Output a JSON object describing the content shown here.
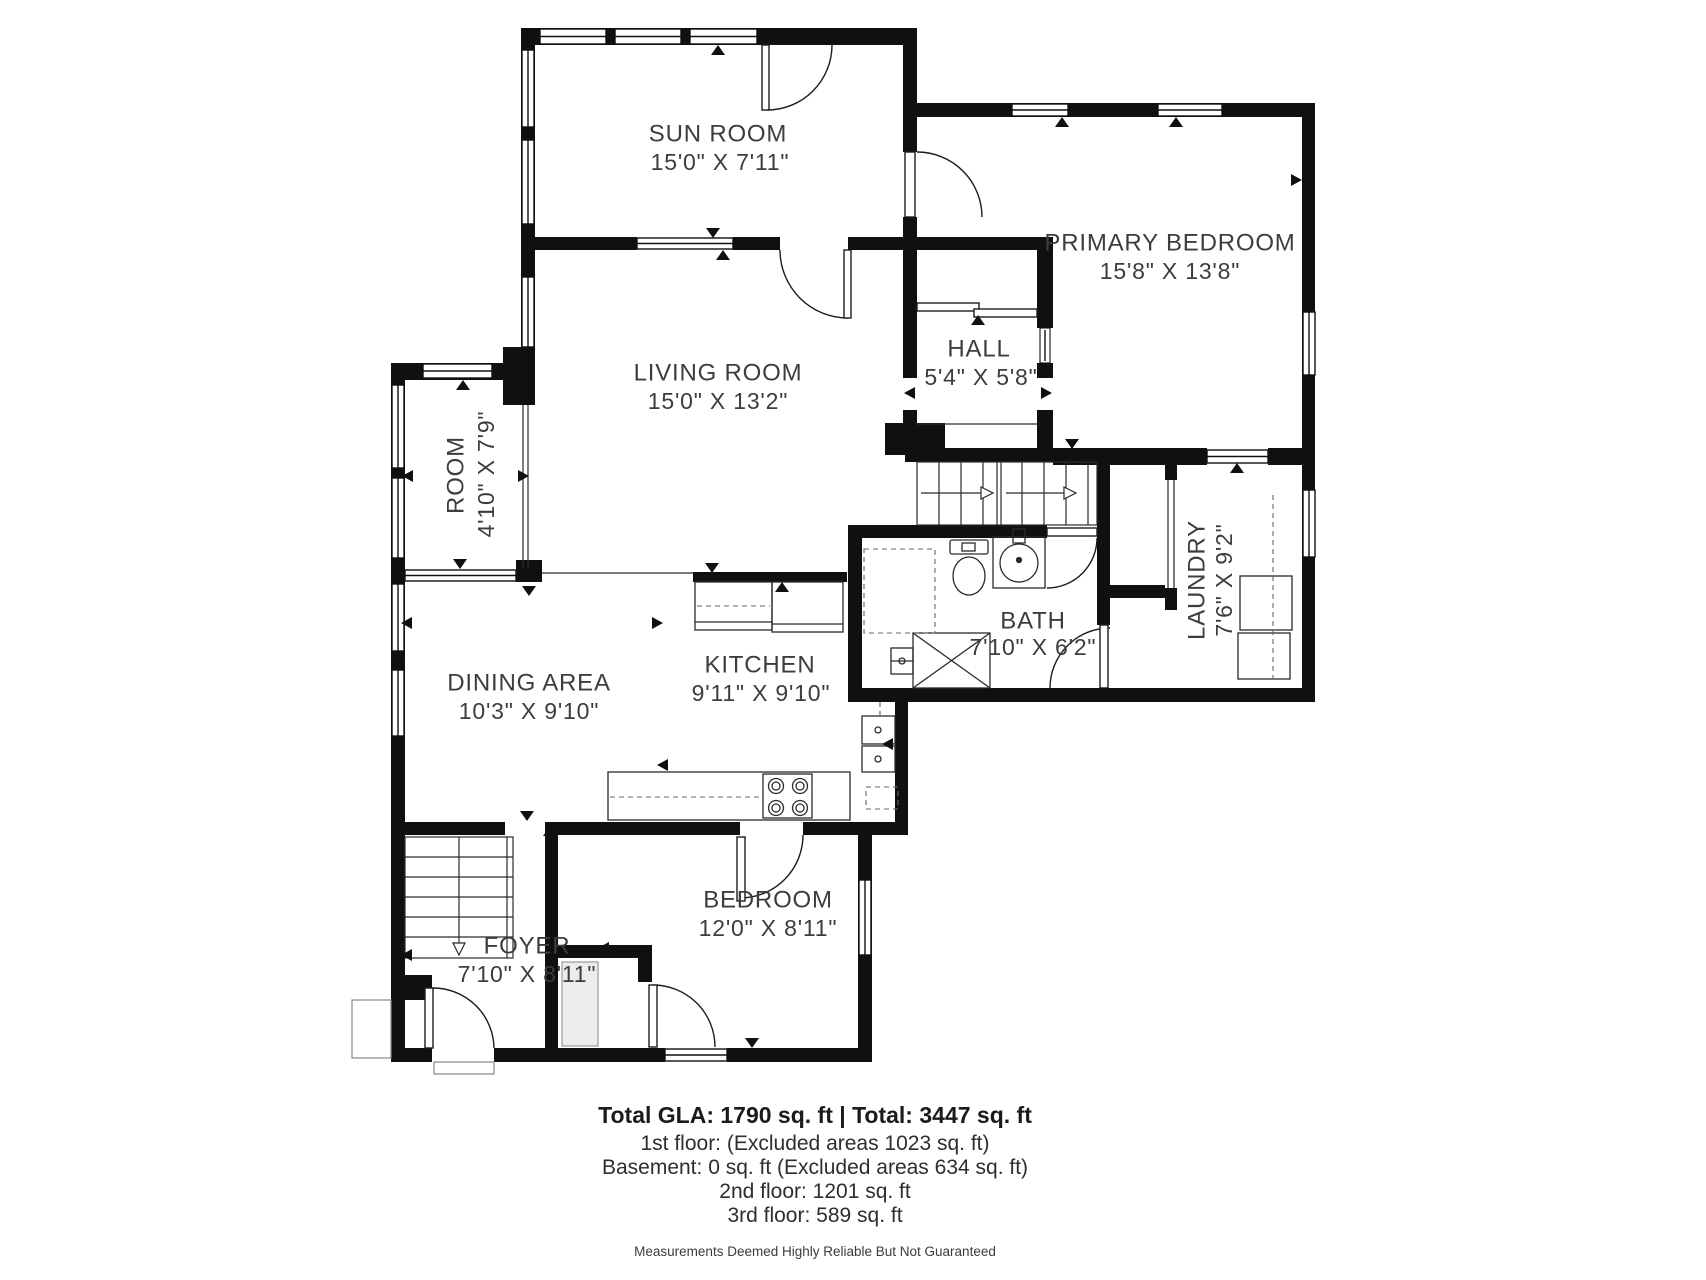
{
  "colors": {
    "walls": "#101010",
    "label_text": "#3a3e41"
  },
  "plan": {
    "rooms": {
      "sun_room": {
        "name": "SUN ROOM",
        "dims": "15'0\" X 7'11\""
      },
      "living_room": {
        "name": "LIVING ROOM",
        "dims": "15'0\" X 13'2\""
      },
      "primary_bedroom": {
        "name": "PRIMARY BEDROOM",
        "dims": "15'8\" X 13'8\""
      },
      "hall": {
        "name": "HALL",
        "dims": "5'4\" X 5'8\""
      },
      "room": {
        "name": "ROOM",
        "dims": "4'10\" X 7'9\""
      },
      "laundry": {
        "name": "LAUNDRY",
        "dims": "7'6\" X 9'2\""
      },
      "bath": {
        "name": "BATH",
        "dims": "7'10\" X 6'2\""
      },
      "dining_area": {
        "name": "DINING AREA",
        "dims": "10'3\" X 9'10\""
      },
      "kitchen": {
        "name": "KITCHEN",
        "dims": "9'11\" X 9'10\""
      },
      "foyer": {
        "name": "FOYER",
        "dims": "7'10\" X 8'11\""
      },
      "bedroom": {
        "name": "BEDROOM",
        "dims": "12'0\" X 8'11\""
      }
    }
  },
  "footer": {
    "totals": "Total GLA: 1790 sq. ft | Total: 3447 sq. ft",
    "floor1": "1st floor: (Excluded areas 1023 sq. ft)",
    "basement": "Basement: 0 sq. ft (Excluded areas 634 sq. ft)",
    "floor2": "2nd floor: 1201 sq. ft",
    "floor3": "3rd floor: 589 sq. ft",
    "disclaimer": "Measurements Deemed Highly Reliable But Not Guaranteed"
  }
}
